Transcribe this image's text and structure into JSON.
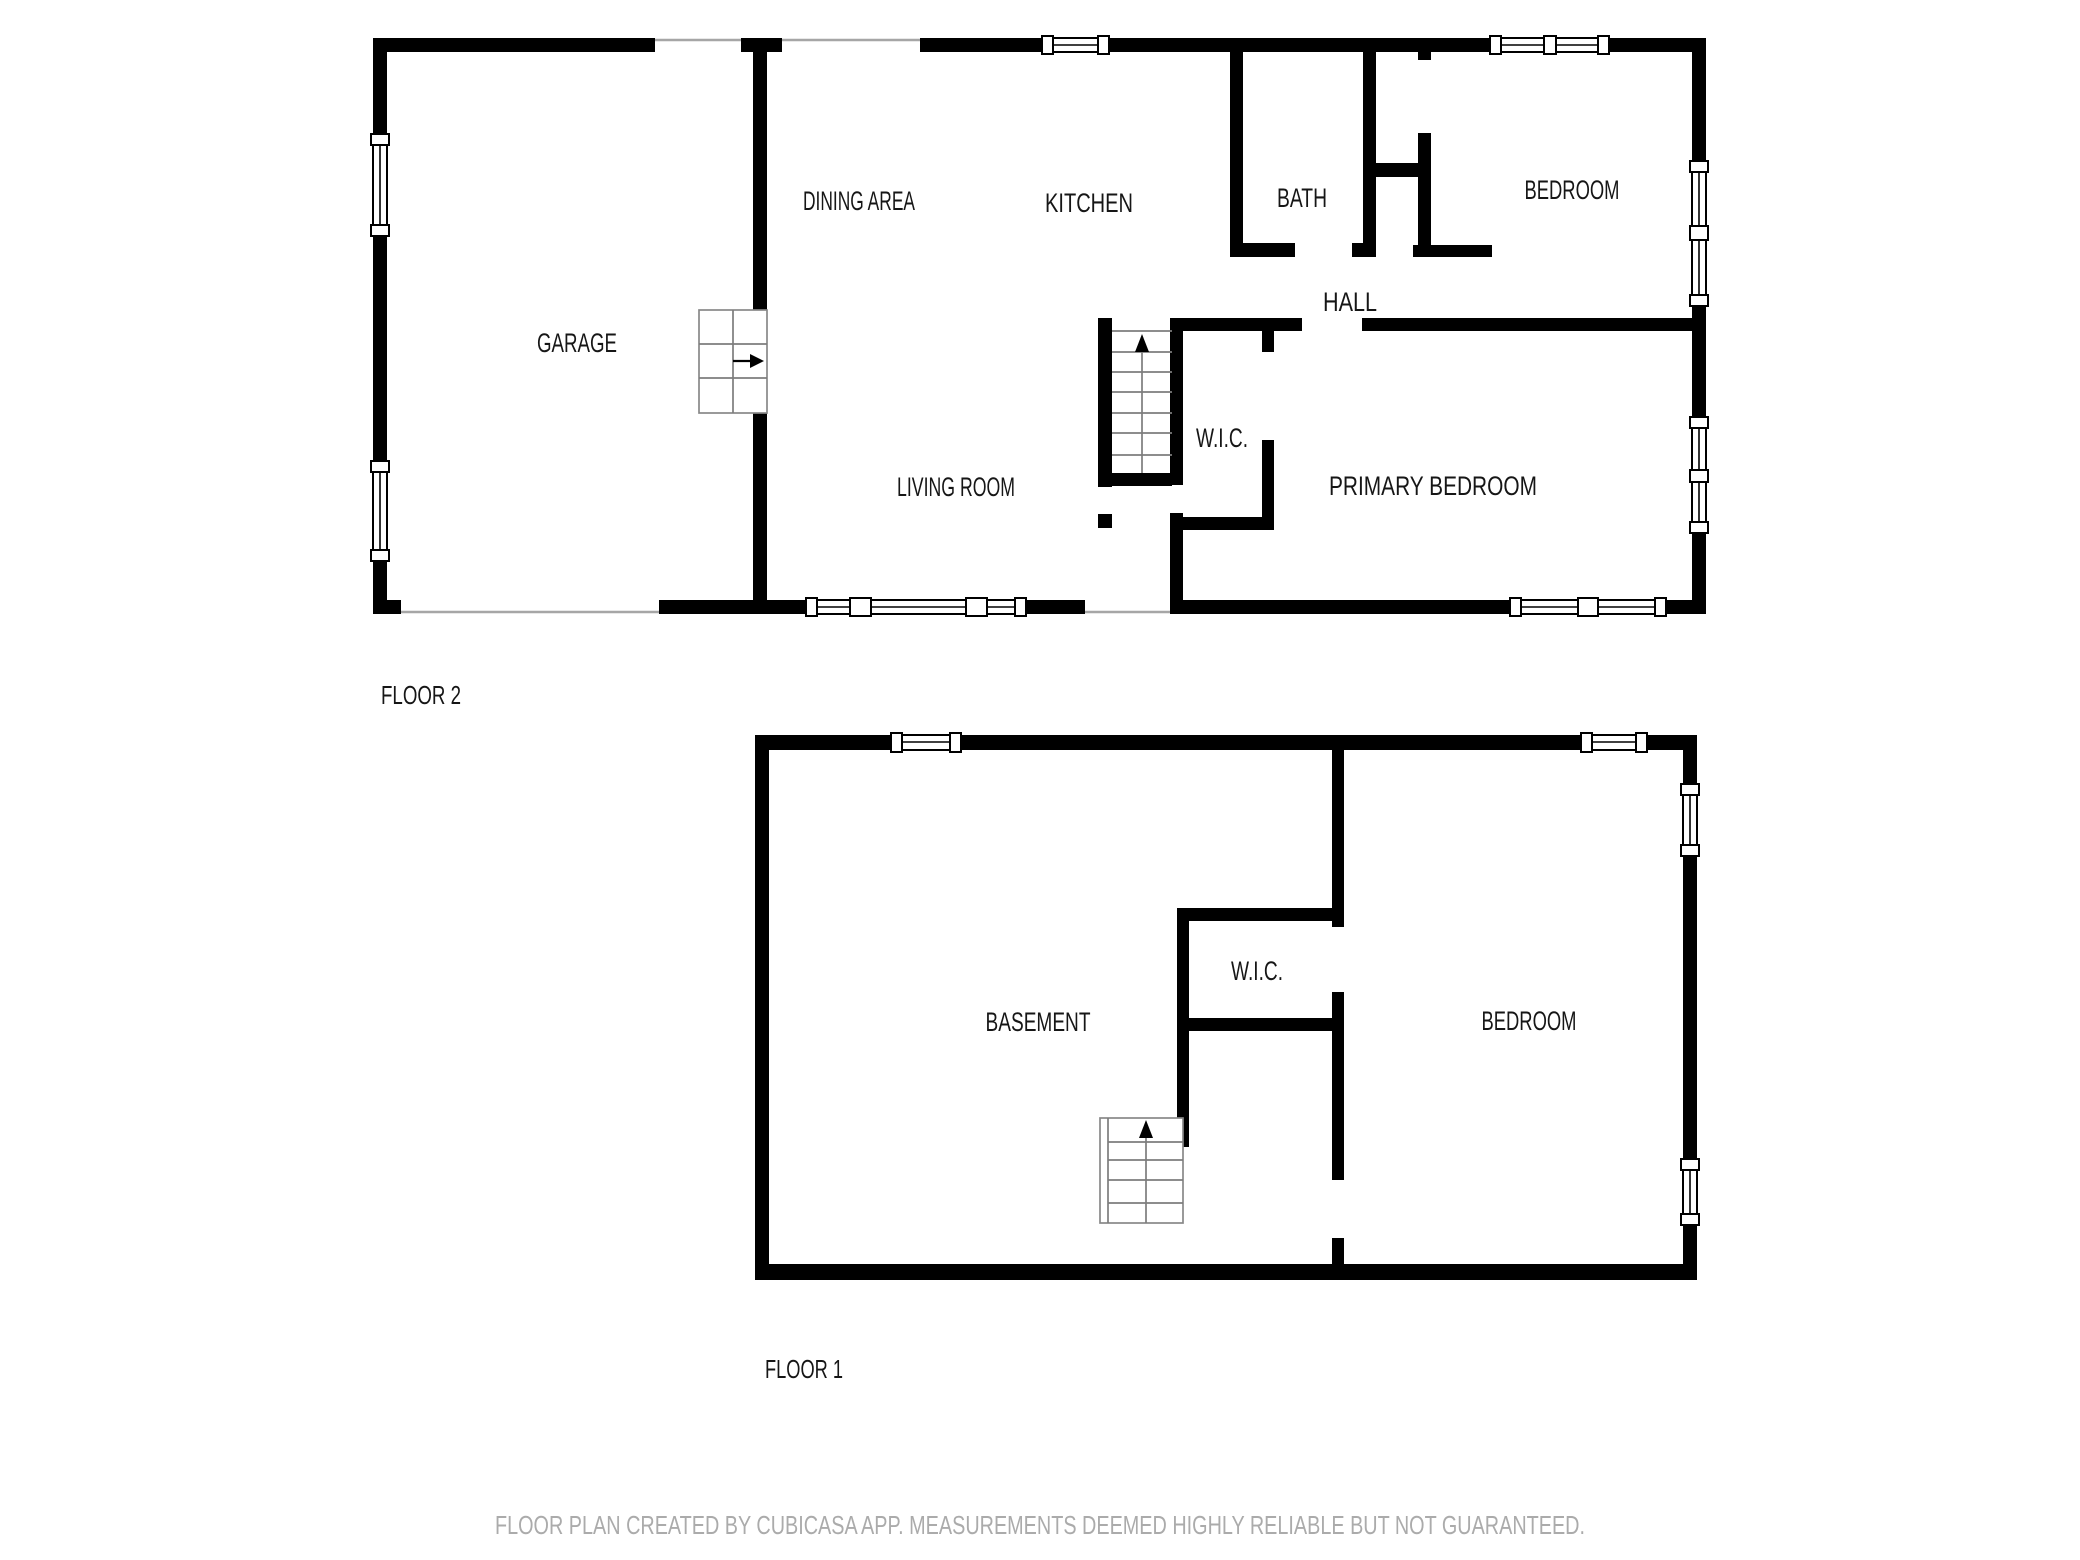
{
  "floor2": {
    "label": "FLOOR 2",
    "rooms": {
      "garage": "GARAGE",
      "dining": "DINING AREA",
      "kitchen": "KITCHEN",
      "bath": "BATH",
      "bedroom": "BEDROOM",
      "hall": "HALL",
      "wic": "W.I.C.",
      "living": "LIVING ROOM",
      "primary": "PRIMARY BEDROOM"
    }
  },
  "floor1": {
    "label": "FLOOR 1",
    "rooms": {
      "basement": "BASEMENT",
      "wic": "W.I.C.",
      "bedroom": "BEDROOM"
    }
  },
  "footer": {
    "disclaimer": "FLOOR PLAN CREATED BY CUBICASA APP. MEASUREMENTS DEEMED HIGHLY RELIABLE BUT NOT GUARANTEED."
  },
  "colors": {
    "wall": "#000000",
    "background": "#ffffff",
    "label_text": "#161616",
    "footer_text": "#ababab",
    "opening_line": "#a6a6a6",
    "stair_line": "#7d7d7d"
  }
}
